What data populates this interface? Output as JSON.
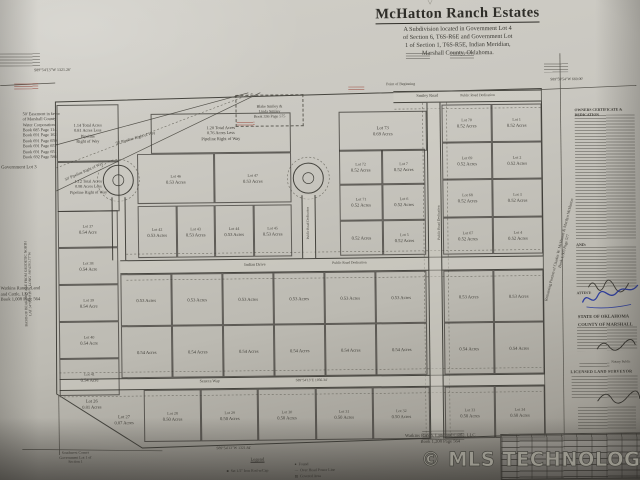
{
  "title_block": {
    "marker": "▽",
    "title": "McHatton Ranch Estates",
    "subtitle_lines": [
      "A Subdivision located in Government Lot 4",
      "of Section 6, T6S-R6E and Government Lot",
      "1 of Section 1, T6S-R5E, Indian Meridian,",
      "Marshall County, Oklahoma."
    ]
  },
  "watermark": "© MLS TECHNOLOGY INC 2025",
  "certificates": {
    "owners_heading": "OWNERS CERTIFICATE & DEDICATION",
    "and_label": "AND:",
    "attest_label": "ATTEST:",
    "state_line": "STATE OF OKLAHOMA",
    "county_line": "COUNTY OF MARSHALL",
    "notary_label": "Notary Public",
    "surveyor_heading": "LICENSED LAND SURVEYOR"
  },
  "legend": {
    "title": "Legend",
    "items": [
      {
        "symbol": "■",
        "label": "Set 1/2\" Iron Rod w/Cap"
      },
      {
        "symbol": "●",
        "label": "Found"
      },
      {
        "symbol": "—",
        "label": "Over Head Power Line"
      },
      {
        "symbol": "▨",
        "label": "Covered Area"
      }
    ]
  },
  "map": {
    "roads": [
      {
        "x": 395,
        "y": 92,
        "w": 148,
        "h": 12
      },
      {
        "x": 120,
        "y": 258,
        "w": 423,
        "h": 14
      },
      {
        "x": 58,
        "y": 376,
        "w": 485,
        "h": 12
      },
      {
        "x": 428,
        "y": 104,
        "w": 14,
        "h": 336,
        "vert": true
      },
      {
        "x": 112,
        "y": 195,
        "w": 14,
        "h": 63,
        "vert": true
      },
      {
        "x": 302,
        "y": 195,
        "w": 14,
        "h": 63,
        "vert": true
      }
    ],
    "blocks": [
      {
        "x": 443,
        "y": 106,
        "w": 100,
        "h": 150,
        "cols": 2,
        "rows": 4,
        "cells": [
          {
            "n": "Lot 70",
            "a": "0.52 Acres"
          },
          {
            "n": "Lot 1",
            "a": "0.52 Acres"
          },
          {
            "n": "Lot 69",
            "a": "0.52 Acres"
          },
          {
            "n": "Lot 2",
            "a": "0.52 Acres"
          },
          {
            "n": "Lot 68",
            "a": "0.52 Acres"
          },
          {
            "n": "Lot 3",
            "a": "0.52 Acres"
          },
          {
            "n": "Lot 67",
            "a": "0.52 Acres"
          },
          {
            "n": "Lot 4",
            "a": "0.52 Acres"
          }
        ]
      },
      {
        "x": 340,
        "y": 150,
        "w": 86,
        "h": 106,
        "cols": 2,
        "rows": 3,
        "cells": [
          {
            "n": "Lot 72",
            "a": "0.52 Acres"
          },
          {
            "n": "Lot 7",
            "a": "0.52 Acres"
          },
          {
            "n": "Lot 71",
            "a": "0.52 Acres"
          },
          {
            "n": "Lot 6",
            "a": "0.52 Acres"
          },
          {
            "a": "0.52 Acres"
          },
          {
            "n": "Lot 5",
            "a": "0.52 Acres"
          }
        ]
      },
      {
        "x": 138,
        "y": 152,
        "w": 154,
        "h": 50,
        "cols": 2,
        "rows": 1,
        "cells": [
          {
            "n": "Lot 46",
            "a": "0.53 Acres"
          },
          {
            "n": "Lot 47",
            "a": "0.53 Acres"
          }
        ]
      },
      {
        "x": 138,
        "y": 204,
        "w": 154,
        "h": 52,
        "cols": 4,
        "rows": 1,
        "cells": [
          {
            "n": "Lot 42",
            "a": "0.53 Acres"
          },
          {
            "n": "Lot 43",
            "a": "0.53 Acres"
          },
          {
            "n": "Lot 44",
            "a": "0.53 Acres"
          },
          {
            "n": "Lot 45",
            "a": "0.53 Acres"
          }
        ]
      },
      {
        "x": 120,
        "y": 272,
        "w": 306,
        "h": 52,
        "cols": 6,
        "rows": 1,
        "cells": [
          {
            "a": "0.53 Acres"
          },
          {
            "a": "0.53 Acres"
          },
          {
            "a": "0.53 Acres"
          },
          {
            "a": "0.53 Acres"
          },
          {
            "a": "0.53 Acres"
          },
          {
            "a": "0.53 Acres"
          }
        ]
      },
      {
        "x": 443,
        "y": 272,
        "w": 100,
        "h": 52,
        "cols": 2,
        "rows": 1,
        "cells": [
          {
            "a": "0.53 Acres"
          },
          {
            "a": "0.53 Acres"
          }
        ]
      },
      {
        "x": 120,
        "y": 324,
        "w": 306,
        "h": 52,
        "cols": 6,
        "rows": 1,
        "cells": [
          {
            "a": "0.54 Acres"
          },
          {
            "a": "0.54 Acres"
          },
          {
            "a": "0.54 Acres"
          },
          {
            "a": "0.54 Acres"
          },
          {
            "a": "0.54 Acres"
          },
          {
            "a": "0.54 Acres"
          }
        ]
      },
      {
        "x": 443,
        "y": 324,
        "w": 100,
        "h": 52,
        "cols": 2,
        "rows": 1,
        "cells": [
          {
            "a": "0.54 Acres"
          },
          {
            "a": "0.54 Acres"
          }
        ]
      },
      {
        "x": 58,
        "y": 208,
        "w": 60,
        "h": 185,
        "cols": 1,
        "rows": 5,
        "cells": [
          {
            "n": "Lot 37",
            "a": "0.54 Acre"
          },
          {
            "n": "Lot 38",
            "a": "0.54 Acre"
          },
          {
            "n": "Lot 39",
            "a": "0.54 Acre"
          },
          {
            "n": "Lot 40",
            "a": "0.54 Acre"
          },
          {
            "n": "Lot 41",
            "a": "0.54 Acre"
          }
        ]
      },
      {
        "x": 142,
        "y": 388,
        "w": 286,
        "h": 52,
        "cols": 5,
        "rows": 1,
        "cells": [
          {
            "n": "Lot 28",
            "a": "0.50 Acres"
          },
          {
            "n": "Lot 29",
            "a": "0.50 Acres"
          },
          {
            "n": "Lot 30",
            "a": "0.50 Acres"
          },
          {
            "n": "Lot 31",
            "a": "0.50 Acres"
          },
          {
            "n": "Lot 32",
            "a": "0.50 Acres"
          }
        ]
      },
      {
        "x": 443,
        "y": 388,
        "w": 100,
        "h": 52,
        "cols": 2,
        "rows": 1,
        "cells": [
          {
            "n": "Lot 33",
            "a": "0.50 Acres"
          },
          {
            "n": "Lot 34",
            "a": "0.50 Acres"
          }
        ]
      }
    ],
    "textblocks": [
      {
        "x": 340,
        "y": 112,
        "w": 86,
        "h": 38,
        "fs": 4.6,
        "border": true,
        "lines": [
          "Lot 73",
          "0.69 Acres"
        ]
      },
      {
        "x": 152,
        "y": 112,
        "w": 138,
        "h": 38,
        "fs": 4.4,
        "border": true,
        "lines": [
          "1.20 Total Acres",
          "0.76 Acres Less",
          "Pipeline Right of Way"
        ]
      },
      {
        "x": 58,
        "y": 102,
        "w": 60,
        "h": 55,
        "fs": 4.3,
        "border": true,
        "lines": [
          "1.14 Total Acres",
          "0.81 Acres Less",
          "Pipeline",
          "Right of Way"
        ]
      },
      {
        "x": 58,
        "y": 159,
        "w": 60,
        "h": 48,
        "fs": 4.2,
        "border": true,
        "lines": [
          "1.12 Total Acres",
          "0.98 Acres Less",
          "Pipeline Right of Way"
        ]
      },
      {
        "x": 64,
        "y": 396,
        "w": 52,
        "fs": 4.5,
        "lines": [
          "Lot 26",
          "0.81 Acres"
        ]
      },
      {
        "x": 96,
        "y": 412,
        "w": 52,
        "fs": 4.5,
        "lines": [
          "Lot 27",
          "0.87 Acres"
        ]
      },
      {
        "x": 237,
        "y": 94,
        "w": 66,
        "h": 30,
        "fs": 4,
        "dashed": true,
        "lines": [
          "Blake Smiley &",
          "Linda Smiley",
          "Book 336 Page 575"
        ]
      },
      {
        "x": 24,
        "y": 108,
        "w": 76,
        "fs": 4.3,
        "align": "left",
        "lines": [
          "50' Easement in favor",
          "of Marshall County",
          "Water Corporation:",
          "Book 685 Page 114",
          "Book 691 Page 162",
          "Book 691 Page 659",
          "Book 691 Page 657",
          "Book 691 Page 651",
          "Book 692 Page 586"
        ]
      },
      {
        "x": 0,
        "y": 282,
        "w": 62,
        "fs": 4.6,
        "align": "left",
        "lines": [
          "Watkins Ranch, Land",
          "and Cattle, LLC",
          "Book 1,008 Page 564"
        ]
      },
      {
        "x": 368,
        "y": 434,
        "w": 140,
        "fs": 4.6,
        "lines": [
          "Watkins Ranch, Land and Cattle, LLC",
          "Book 1,208 Page 564"
        ]
      },
      {
        "x": 44,
        "y": 448,
        "w": 58,
        "fs": 3.8,
        "lines": [
          "Southwest Corner",
          "Government Lot 1 of",
          "Section 1"
        ]
      },
      {
        "x": 486,
        "y": 248,
        "w": 150,
        "fs": 4,
        "rot": -75,
        "lines": [
          "Remaining Portion of Charles W. McHatton & Marilyn McHatton",
          "Book 1,303 Page 577"
        ]
      },
      {
        "x": -42,
        "y": 276,
        "w": 140,
        "fs": 3.6,
        "rot": -90,
        "lines": [
          "BASIS OF BEARINGS ARE FROM GEODETIC NORTH",
          "LAT 34°00'00.10\"N   LONG -96°43'03.77\"W"
        ]
      }
    ],
    "notes": [
      {
        "t": "S89°54'13\"W 1321.26'",
        "x": 36,
        "y": 64,
        "fs": 4
      },
      {
        "t": "S89°59'54\"W 660.00'",
        "x": 552,
        "y": 80,
        "fs": 3.8
      },
      {
        "t": "Point of Beginning",
        "x": 388,
        "y": 83,
        "fs": 3.8
      },
      {
        "t": "Smiley Road",
        "x": 418,
        "y": 94,
        "fs": 4.2
      },
      {
        "t": "Public Road Dedication",
        "x": 462,
        "y": 94.6,
        "fs": 3.6
      },
      {
        "t": "Indian Drive",
        "x": 244,
        "y": 260.8,
        "fs": 4.2
      },
      {
        "t": "Public Road Dedication",
        "x": 332,
        "y": 261.2,
        "fs": 3.6
      },
      {
        "t": "Seneca Way",
        "x": 198,
        "y": 377.4,
        "fs": 4.2
      },
      {
        "t": "S89°54'13\"E 1056.34'",
        "x": 294,
        "y": 377.8,
        "fs": 3.6
      },
      {
        "t": "S89°54'13\"W 1321.84'",
        "x": 214,
        "y": 445,
        "fs": 3.8
      },
      {
        "t": "Government Lot 3",
        "x": 2,
        "y": 162,
        "fs": 4.8
      },
      {
        "t": "Public Road Dedication",
        "x": 404,
        "y": 222,
        "fs": 3.6,
        "rot": -90,
        "w": 70
      },
      {
        "t": "Public Road Dedication",
        "x": 276,
        "y": 221,
        "fs": 3.4,
        "rot": -90,
        "w": 64
      },
      {
        "t": "50' Pipeline Right of Way",
        "x": 116,
        "y": 133,
        "fs": 4,
        "rot": -15
      },
      {
        "t": "50' Pipeline Right of Way",
        "x": 64,
        "y": 166,
        "fs": 4,
        "rot": -23
      }
    ],
    "blurs": [
      {
        "x": 2,
        "y": 50,
        "w": 40,
        "h": 13,
        "lh": 3
      },
      {
        "x": 546,
        "y": 66,
        "w": 24,
        "h": 9,
        "lh": 2.8
      },
      {
        "x": 350,
        "y": 87,
        "w": 16,
        "h": 5,
        "lh": 2.5,
        "red": true
      },
      {
        "x": 238,
        "y": 121,
        "w": 18,
        "h": 5,
        "lh": 2.5,
        "red": true
      },
      {
        "x": 16,
        "y": 80,
        "w": 24,
        "h": 6,
        "lh": 2.5,
        "red": true
      },
      {
        "x": 408,
        "y": 54,
        "w": 24,
        "h": 7,
        "lh": 2.6
      },
      {
        "x": 452,
        "y": 54,
        "w": 24,
        "h": 7,
        "lh": 2.6
      },
      {
        "x": 576,
        "y": 118,
        "w": 60,
        "h": 124,
        "lh": 3
      },
      {
        "x": 576,
        "y": 250,
        "w": 60,
        "h": 40,
        "lh": 3
      },
      {
        "x": 576,
        "y": 330,
        "w": 60,
        "h": 24,
        "lh": 3
      },
      {
        "x": 570,
        "y": 379,
        "w": 66,
        "h": 22,
        "lh": 3
      },
      {
        "x": 576,
        "y": 410,
        "w": 58,
        "h": 22,
        "lh": 3
      },
      {
        "x": 578,
        "y": 366,
        "w": 30,
        "h": 4,
        "lh": 3
      },
      {
        "x": 420,
        "y": 432,
        "w": 42,
        "h": 10,
        "lh": 2.8
      }
    ]
  }
}
